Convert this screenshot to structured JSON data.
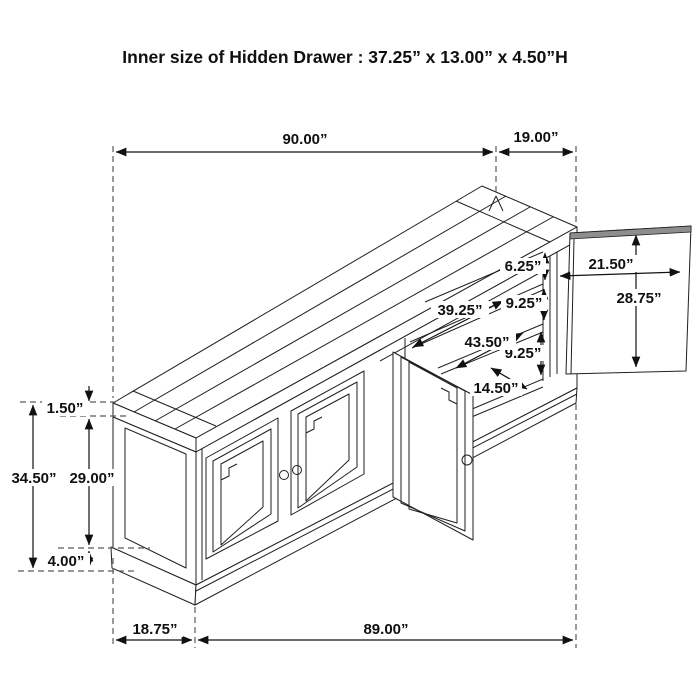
{
  "title": "Inner size of Hidden Drawer : 37.25” x 13.00” x 4.50”H",
  "colors": {
    "line": "#1f1f1f",
    "dimension": "#111111",
    "extension_dash": "#5a5a5a",
    "panel_edge_strip": "#8e8e8e",
    "background": "#ffffff"
  },
  "dimensions": {
    "top_length": "90.00”",
    "top_depth": "19.00”",
    "open_door_width": "21.50”",
    "open_door_height": "28.75”",
    "shelf_gap_top": "6.25”",
    "shelf_gap_middle": "9.25”",
    "shelf_length_upper": "39.25”",
    "shelf_length_lower": "43.50”",
    "shelf_gap_bottom": "9.25”",
    "interior_depth": "14.50”",
    "top_thickness": "1.50”",
    "overall_height": "34.50”",
    "body_height": "29.00”",
    "base_height": "4.00”",
    "side_depth": "18.75”",
    "front_length": "89.00”"
  }
}
